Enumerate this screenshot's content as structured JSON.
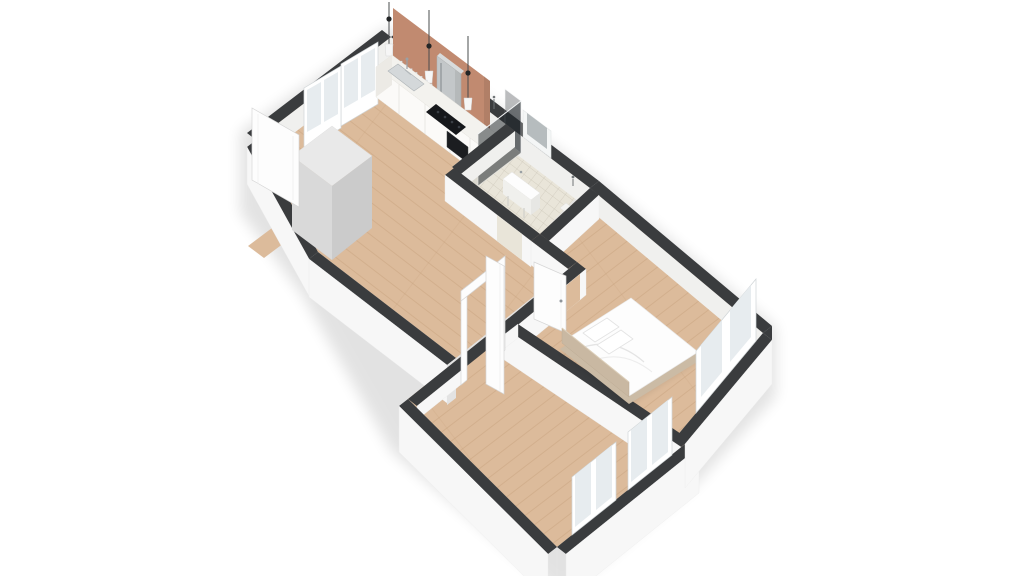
{
  "canvas": {
    "width": 1024,
    "height": 576
  },
  "palette": {
    "wood": "#dcbb9b",
    "wood_line": "#c39c77",
    "tile": "#e9e5d9",
    "tile_line": "#b9b3a4",
    "wall_top": "#3a3c3e",
    "face": "#f7f7f7",
    "face_inner": "#f0f0ee",
    "end": "#e3e3e3",
    "copper": "#c18a70",
    "counter_top": "#f3f2ee",
    "counter_front": "#fbfaf8",
    "cooktop": "#16181b",
    "steel": "#c3c7c9",
    "glass": "#e7ecef",
    "glass_dark": "#20262b",
    "closet": "#d9d9d9",
    "bed_base": "#c9b8a2",
    "linen": "#fdfdfd",
    "shadow": "#000000"
  },
  "scene": {
    "type": "3d-floor-plan",
    "view": "isometric-top",
    "rooms": [
      {
        "id": "kitchen-living-room",
        "floor": "wood",
        "features": [
          "kitchen-counter",
          "sink",
          "faucet",
          "cooktop",
          "oven",
          "refrigerator",
          "copper-feature-wall",
          "glass-shelf",
          "pendant-lamps",
          "balcony-glass-doors",
          "entry-door",
          "closet",
          "entry-mat"
        ]
      },
      {
        "id": "hallway",
        "floor": "wood",
        "features": [
          "bathroom-doorway",
          "bedroom-door",
          "living-room-doorway-frame",
          "living-room-door"
        ]
      },
      {
        "id": "bathroom",
        "floor": "tile",
        "features": [
          "shower",
          "shower-glass-screen",
          "washbasin",
          "toilet",
          "mirror",
          "wall-hooks"
        ]
      },
      {
        "id": "bedroom",
        "floor": "wood",
        "features": [
          "double-bed",
          "headboard",
          "pillows",
          "window"
        ]
      },
      {
        "id": "living-room",
        "floor": "wood",
        "features": [
          "window",
          "window"
        ]
      }
    ]
  }
}
